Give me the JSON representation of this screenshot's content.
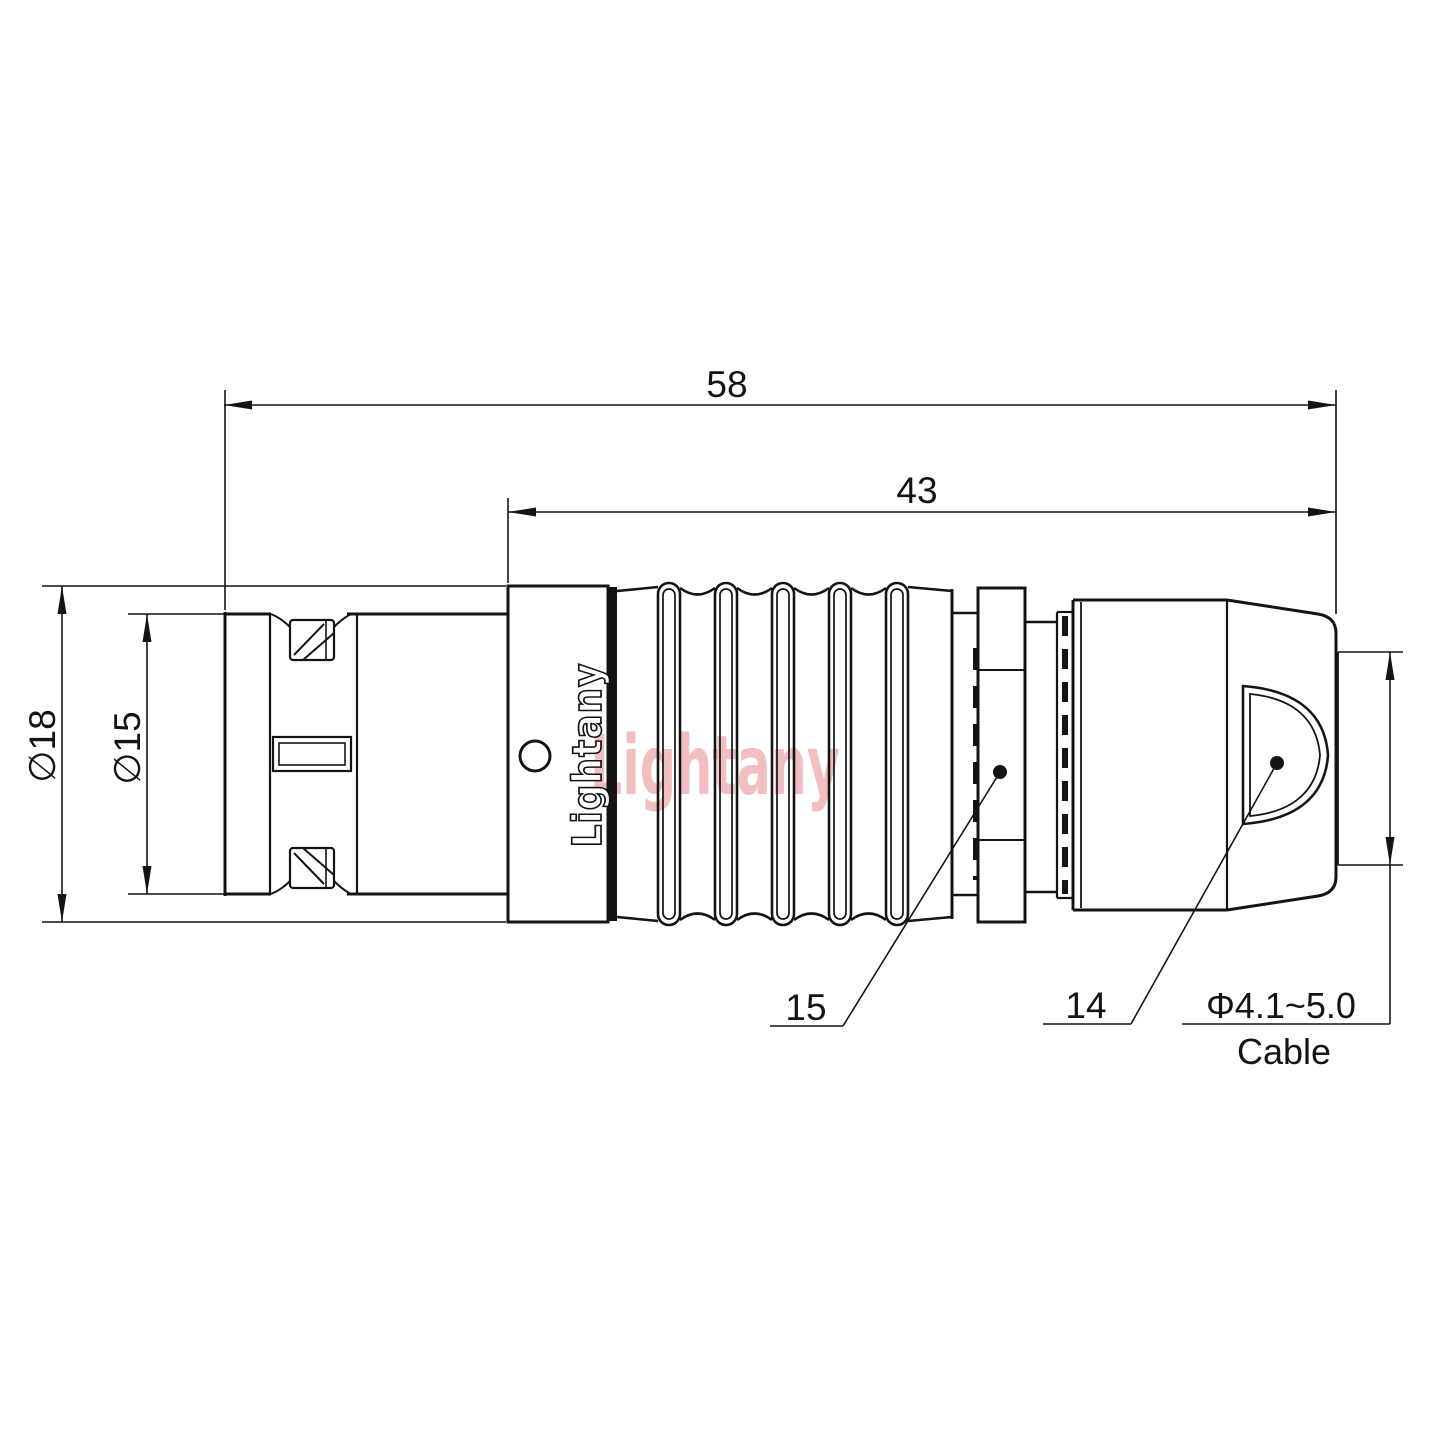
{
  "page": {
    "background": "#ffffff"
  },
  "diagram": {
    "type": "connector-technical-drawing",
    "line_color": "#141414",
    "brand_text": "Lightany",
    "watermark": {
      "text": "Lightany",
      "color": "#f1bfc2"
    },
    "dimensions": {
      "overall_length": "58",
      "rear_section_length": "43",
      "outer_diameter": "∅18",
      "inner_diameter": "∅15",
      "cable_diameter_range": "Φ4.1~5.0",
      "cable_caption": "Cable"
    },
    "part_labels": {
      "gland_nut": "15",
      "back_boot": "14"
    }
  }
}
